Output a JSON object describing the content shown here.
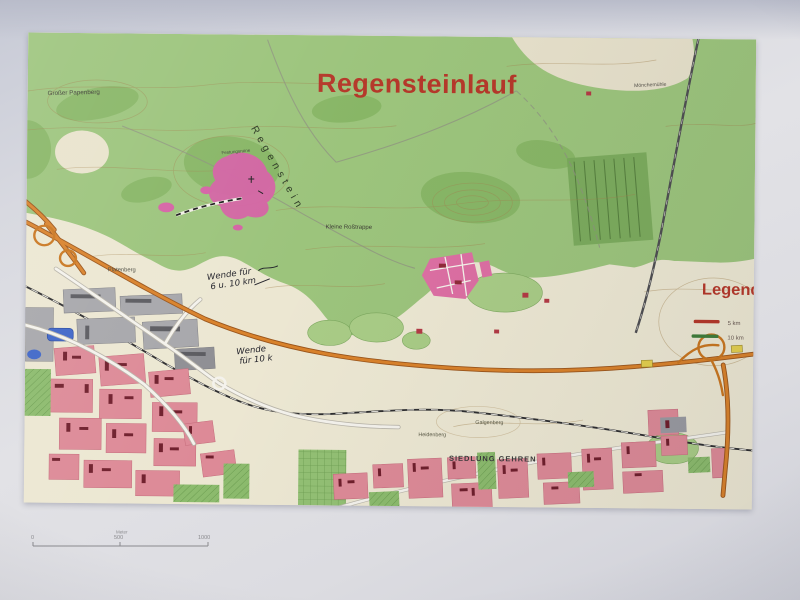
{
  "map": {
    "title": "Regensteinlauf",
    "legend": {
      "title": "Legende",
      "items": [
        {
          "label": "5 km",
          "color": "#b5382a"
        },
        {
          "label": "10 km",
          "color": "#3f7d3a"
        }
      ]
    },
    "labels": {
      "grosser_papenberg": "Großer Papenberg",
      "regenstein": "Regenstein",
      "festungsruine": "Festungsruine",
      "kleine_rosstrappe": "Kleine Roßtrappe",
      "platenberg": "Platenberg",
      "moenchemuehle": "Mönchemühle",
      "galgenberg": "Galgenberg",
      "heidenberg": "Heidenberg",
      "siedlung_gehren": "SIEDLUNG GEHREN"
    },
    "annotations": {
      "a1_line1": "Wende für",
      "a1_line2": "6 u. 10 km",
      "a2_line1": "Wende",
      "a2_line2": "für 10 k"
    },
    "scalebar": {
      "zero": "0",
      "mid": "500",
      "end": "1000",
      "unit": "Meter"
    },
    "colors": {
      "title_red": "#b5382a",
      "forest_green": "#9cc47c",
      "urban_pink": "#dd8a97",
      "ruin_magenta": "#d563a5",
      "highway_orange": "#d9822b",
      "water_blue": "#3f66c8"
    }
  }
}
